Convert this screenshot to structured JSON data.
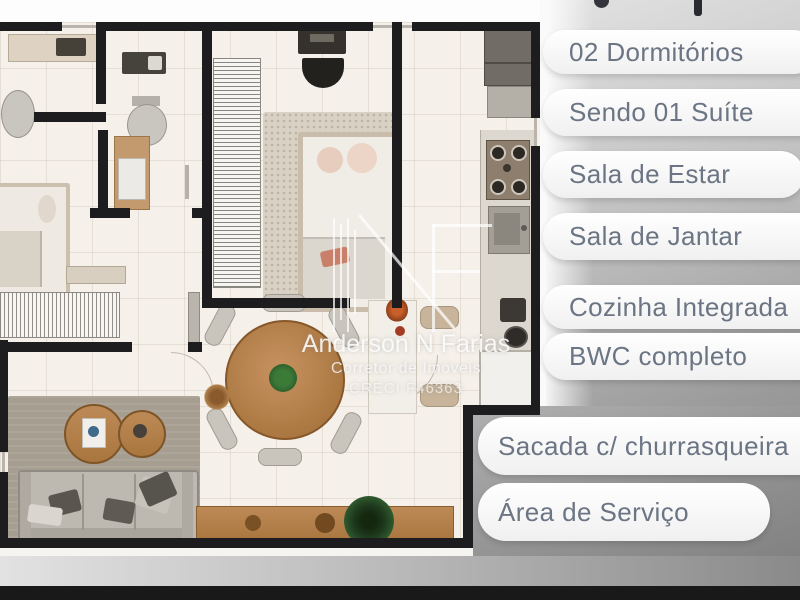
{
  "panel": {
    "items": [
      {
        "label": "02 Dormitórios"
      },
      {
        "label": "Sendo 01 Suíte"
      },
      {
        "label": "Sala de Estar"
      },
      {
        "label": "Sala de Jantar"
      },
      {
        "label": "Cozinha Integrada"
      },
      {
        "label": "BWC completo"
      },
      {
        "label": "Sacada c/ churrasqueira"
      },
      {
        "label": "Área de Serviço"
      }
    ]
  },
  "watermark": {
    "name": "Anderson N Farias",
    "role": "Corretor de Imóveis",
    "license": "CRECI F46363"
  },
  "colors": {
    "pill_text": "#6b7584",
    "pill_background": "#f7f7f7",
    "panel_gray_top": "#d6d6d6",
    "panel_gray_bottom": "#7d7d7d",
    "bottom_bar": "#191919",
    "wall": "#1d1d1f",
    "floor": "#f5f0e9",
    "wood": "#b5814f",
    "plant_green": "#2f5a2f"
  }
}
